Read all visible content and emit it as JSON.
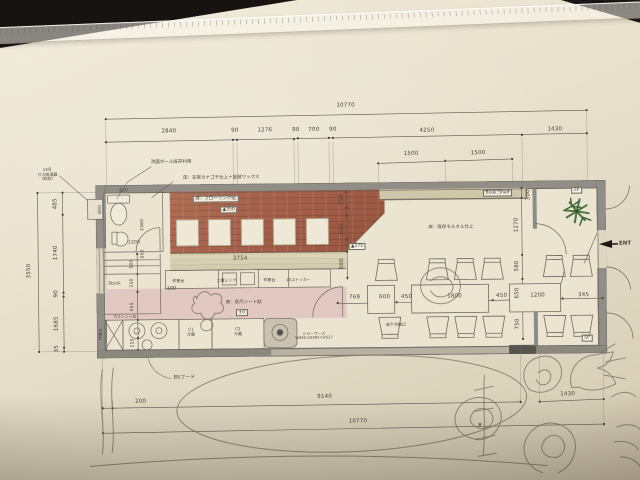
{
  "plan": {
    "labels": {
      "book_shelf": "Book Shelf",
      "sp": "SP",
      "ent": "ENT",
      "stock": "Stock",
      "mortar_floor": "床：既存モルタル仕上",
      "flooring": "床：フローリング貼",
      "sheet_floor": "床：長尺シート貼",
      "plaster_floor": "床：左官カナゴテ仕上＋塗装ワックス",
      "wash_bowl": "洗面ボール既存利用",
      "gas_heater": "13号\nガス給湯器\n（既存）",
      "bs_hood": "BSフード",
      "underfloor_hatch": "床下点検口",
      "showcase": "ショーケース\nW455×D405×H517",
      "work_table": "作業台",
      "sink": "二槽シンク",
      "stocker": "1Gストッカー",
      "gas_range": "ガスレンジ台",
      "fridge1": "C1\n冷蔵",
      "fridge2": "C2\n冷蔵",
      "level_350": "▲350",
      "level_175": "▲175",
      "level_0": "±0",
      "level_m100": "-100"
    },
    "dims": {
      "top_total": "10770",
      "top_row": [
        "2840",
        "90",
        "1276",
        "90",
        "700",
        "90",
        "4250",
        "1430"
      ],
      "inner_row": [
        "1500",
        "1500"
      ],
      "left_total": "3550",
      "left_row": [
        "485",
        "1740",
        "90",
        "1685",
        "35"
      ],
      "toilet_row": [
        "420",
        "600",
        "1560",
        "1200",
        "500"
      ],
      "kitchen_row": [
        "500",
        "310",
        "555",
        "110"
      ],
      "red_row": [
        "350",
        "650",
        "600"
      ],
      "red_width": "3754",
      "right_row": [
        "300",
        "1270",
        "580",
        "650",
        "750"
      ],
      "dining_row": [
        "769",
        "600",
        "450",
        "1800",
        "450",
        "1200",
        "345"
      ],
      "bottom_row": [
        "200",
        "9140",
        "1430"
      ],
      "bottom_total": "10770"
    },
    "colors": {
      "raised_floor_red": "#a4604a",
      "kitchen_floor_pink": "#e2c8c2",
      "counter_tan": "#d8d1b3",
      "wall_gray": "#8e8c85",
      "plant_green": "#47703c",
      "paper": "#e9e1cd"
    }
  }
}
